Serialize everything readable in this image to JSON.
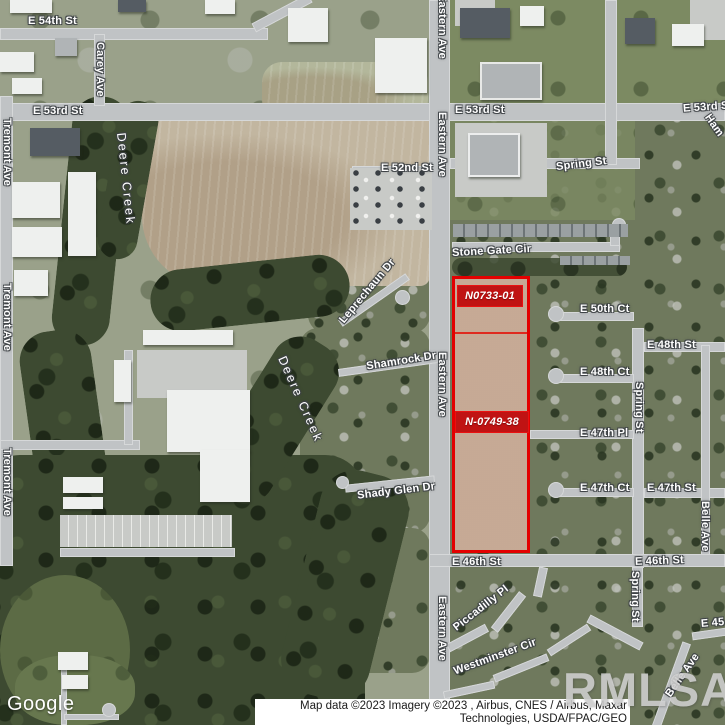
{
  "labels": {
    "e54th_st": "E 54th St",
    "carey_ave": "Carey Ave",
    "e53rd_st": "E 53rd St",
    "tremont_ave": "Tremont Ave",
    "eastern_ave": "Eastern Ave",
    "e52nd_st": "E 52nd St",
    "spring_st": "Spring St",
    "ham_partial": "Ham",
    "deere_creek": "Deere Creek",
    "stone_gate_cir": "Stone Gate Cir",
    "leprechaun_dr": "Leprechaun Dr",
    "shamrock_dr": "Shamrock Dr",
    "e50th_ct": "E 50th Ct",
    "e48th_st": "E 48th St",
    "e48th_ct": "E 48th Ct",
    "e47th_pl": "E 47th Pl",
    "e47th_ct": "E 47th Ct",
    "e47th_st": "E 47th St",
    "belle_ave": "Belle Ave",
    "shady_glen_dr": "Shady Glen Dr",
    "e46th_st": "E 46th St",
    "piccadilly_pl": "Piccadilly Pl",
    "westminster_cir": "Westminster Cir",
    "e45th_partial": "E 45"
  },
  "parcels": {
    "parcel1": "N0733-01",
    "parcel2": "N-0749-38"
  },
  "branding": {
    "google": "Google",
    "watermark": "RMLSA"
  },
  "attribution": {
    "line1": "Map data ©2023 Imagery ©2023 , Airbus, CNES / Airbus, Maxar",
    "line2": "Technologies, USDA/FPAC/GEO"
  },
  "colors": {
    "parcel_outline": "#e30000",
    "parcel_label_bg": "#c01313",
    "road_label_text": "#ffffff",
    "attribution_bg": "#ffffff"
  }
}
